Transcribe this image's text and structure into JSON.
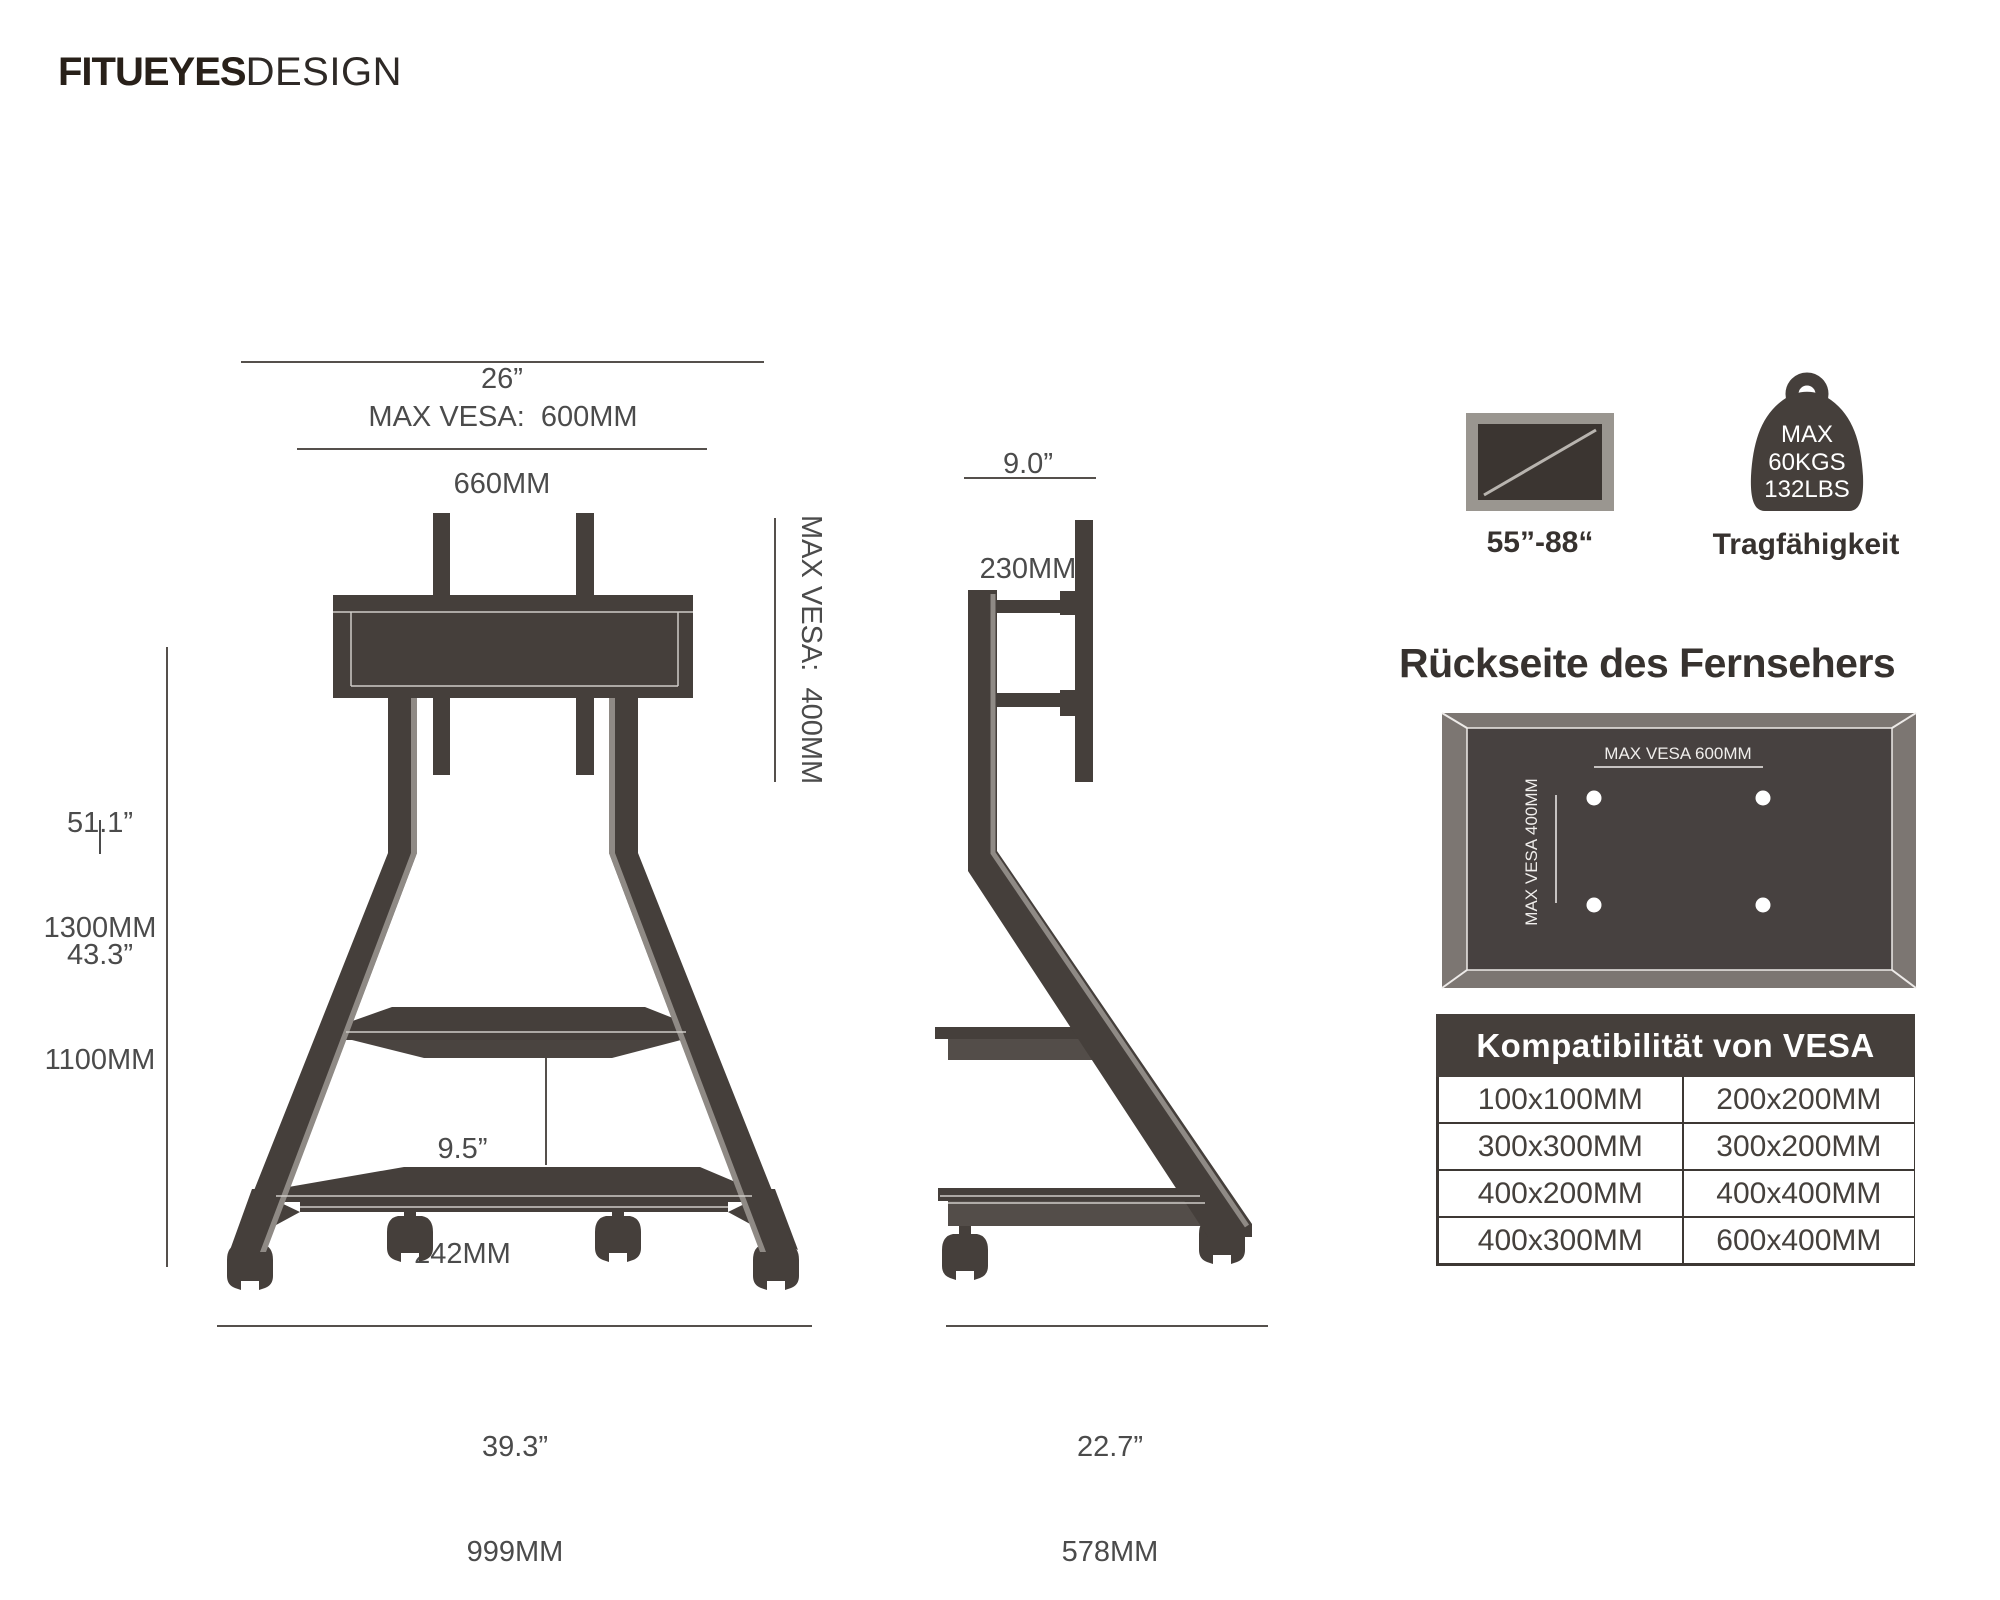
{
  "logo": {
    "brand": "FITUEYES",
    "suffix": "DESIGN"
  },
  "front_view": {
    "top_width": {
      "inch": "26”",
      "mm": "660MM"
    },
    "max_vesa_horizontal": "MAX VESA:  600MM",
    "max_vesa_vertical": "MAX VESA:  400MM",
    "height_max": {
      "inch": "51.1”",
      "mm": "1300MM"
    },
    "height_min": {
      "inch": "43.3”",
      "mm": "1100MM"
    },
    "shelf_gap": {
      "inch": "9.5”",
      "mm": "242MM"
    },
    "base_width": {
      "inch": "39.3”",
      "mm": "999MM"
    }
  },
  "side_view": {
    "top_depth": {
      "inch": "9.0”",
      "mm": "230MM"
    },
    "base_depth": {
      "inch": "22.7”",
      "mm": "578MM"
    }
  },
  "badges": {
    "tv_size_label": "55”-88“",
    "capacity_line1": "MAX",
    "capacity_line2": "60KGS",
    "capacity_line3": "132LBS",
    "capacity_label": "Tragfähigkeit"
  },
  "tv_back": {
    "title": "Rückseite des Fernsehers",
    "vesa_h_label": "MAX VESA 600MM",
    "vesa_v_label": "MAX VESA 400MM"
  },
  "vesa_table": {
    "header": "Kompatibilität von VESA",
    "rows": [
      [
        "100x100MM",
        "200x200MM"
      ],
      [
        "300x300MM",
        "300x200MM"
      ],
      [
        "400x200MM",
        "400x400MM"
      ],
      [
        "400x300MM",
        "600x400MM"
      ]
    ]
  },
  "colors": {
    "drawing_dark": "#453f3b",
    "drawing_accent": "#8f8a85",
    "panel_frame": "#7c7672",
    "panel_inner": "#474140",
    "table_header_bg": "#453f3b"
  }
}
